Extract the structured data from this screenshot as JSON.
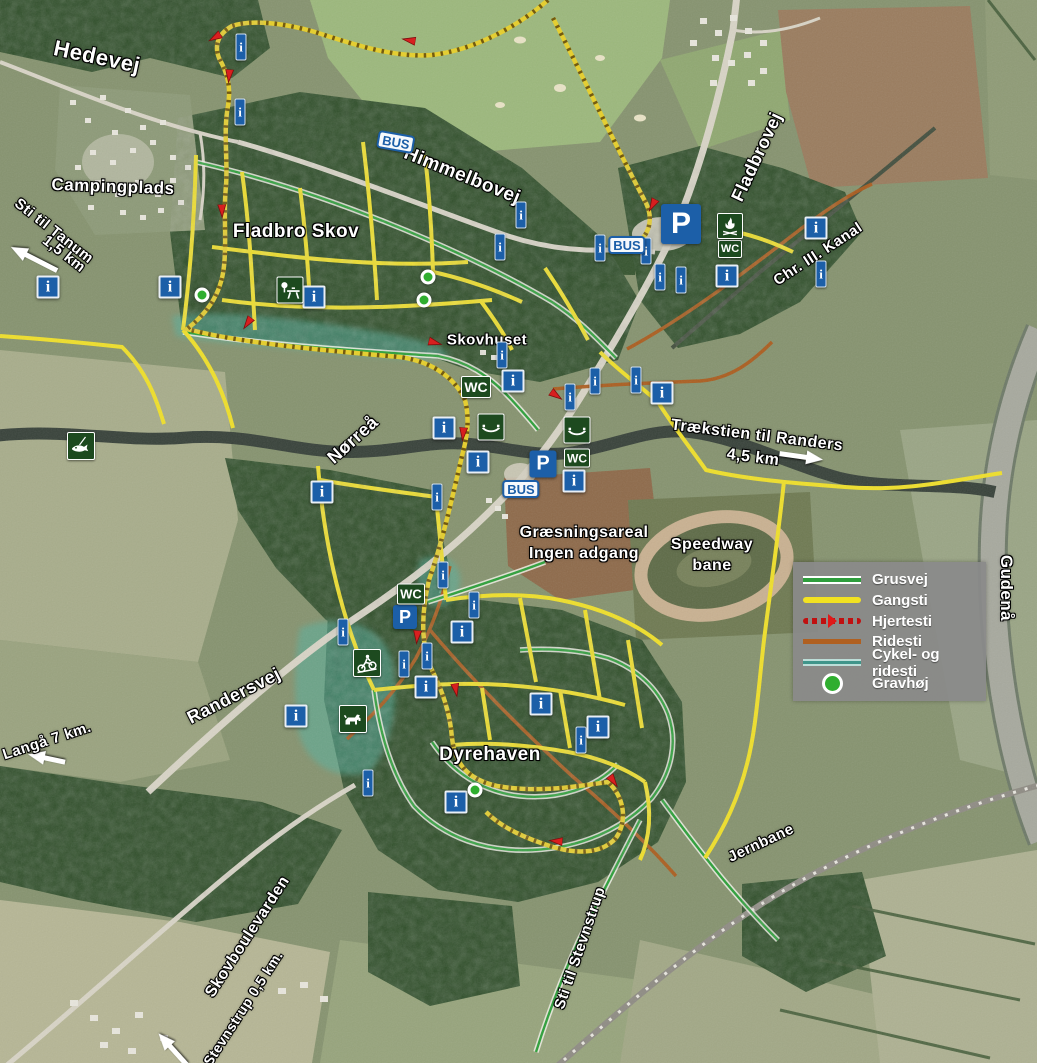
{
  "legend": {
    "items": [
      {
        "label": "Grusvej",
        "type": "grusvej",
        "color": "#2e9e3c"
      },
      {
        "label": "Gangsti",
        "type": "gangsti",
        "color": "#f2e222"
      },
      {
        "label": "Hjertesti",
        "type": "hjertesti",
        "color": "#c01010"
      },
      {
        "label": "Ridesti",
        "type": "ridesti",
        "color": "#b06020"
      },
      {
        "label": "Cykel- og ridesti",
        "type": "cykel",
        "color": "#3f958a"
      },
      {
        "label": "Gravhøj",
        "type": "gravhoj",
        "color": "#2fae2f"
      }
    ]
  },
  "labels": [
    {
      "text": "Hedevej",
      "x": 97,
      "y": 57,
      "rot": 12,
      "size": 22
    },
    {
      "text": "Campingplads",
      "x": 113,
      "y": 187,
      "rot": 2,
      "size": 17
    },
    {
      "text": "Sti til Tanum",
      "x": 54,
      "y": 231,
      "rot": 38,
      "size": 15
    },
    {
      "text": "1,5 km",
      "x": 64,
      "y": 254,
      "rot": 38,
      "size": 15
    },
    {
      "text": "Fladbro Skov",
      "x": 296,
      "y": 232,
      "rot": 0,
      "size": 19
    },
    {
      "text": "Himmelbovej",
      "x": 462,
      "y": 176,
      "rot": 22,
      "size": 19
    },
    {
      "text": "Fladbrovej",
      "x": 757,
      "y": 157,
      "rot": -65,
      "size": 18
    },
    {
      "text": "Chr. III. Kanal",
      "x": 818,
      "y": 254,
      "rot": -33,
      "size": 15
    },
    {
      "text": "Skovhuset",
      "x": 487,
      "y": 340,
      "rot": 0,
      "size": 15
    },
    {
      "text": "Nørreå",
      "x": 353,
      "y": 440,
      "rot": -42,
      "size": 18
    },
    {
      "text": "Trækstien til Randers",
      "x": 757,
      "y": 436,
      "rot": 7,
      "size": 16
    },
    {
      "text": "4,5 km",
      "x": 753,
      "y": 458,
      "rot": 7,
      "size": 16
    },
    {
      "text": "Græsningsareal",
      "x": 584,
      "y": 533,
      "rot": 0,
      "size": 16
    },
    {
      "text": "Ingen adgang",
      "x": 584,
      "y": 554,
      "rot": 0,
      "size": 16
    },
    {
      "text": "Speedway",
      "x": 712,
      "y": 545,
      "rot": 0,
      "size": 16
    },
    {
      "text": "bane",
      "x": 712,
      "y": 566,
      "rot": 0,
      "size": 16
    },
    {
      "text": "Gudenå",
      "x": 1006,
      "y": 588,
      "rot": 90,
      "size": 17
    },
    {
      "text": "Randersvej",
      "x": 234,
      "y": 696,
      "rot": -27,
      "size": 18
    },
    {
      "text": "Langå 7 km.",
      "x": 47,
      "y": 741,
      "rot": -18,
      "size": 15
    },
    {
      "text": "Dyrehaven",
      "x": 490,
      "y": 755,
      "rot": 0,
      "size": 19
    },
    {
      "text": "Jernbane",
      "x": 761,
      "y": 843,
      "rot": -25,
      "size": 15
    },
    {
      "text": "Sti til Stevnstrup",
      "x": 580,
      "y": 948,
      "rot": -71,
      "size": 15
    },
    {
      "text": "Skovboulevarden",
      "x": 248,
      "y": 937,
      "rot": -57,
      "size": 16
    },
    {
      "text": "Stevnstrup 0,5 km.",
      "x": 243,
      "y": 1008,
      "rot": -57,
      "size": 14
    }
  ],
  "arrows": [
    {
      "x": 36,
      "y": 257,
      "rot": 207,
      "len": 54
    },
    {
      "x": 800,
      "y": 459,
      "rot": 8,
      "len": 46
    },
    {
      "x": 48,
      "y": 756,
      "rot": 192,
      "len": 40
    },
    {
      "x": 175,
      "y": 1048,
      "rot": 228,
      "len": 44
    }
  ],
  "icons": [
    {
      "type": "info-small",
      "glyph": "i",
      "x": 241,
      "y": 47
    },
    {
      "type": "info-small",
      "glyph": "i",
      "x": 240,
      "y": 112
    },
    {
      "type": "info-small",
      "glyph": "i",
      "x": 521,
      "y": 215
    },
    {
      "type": "info-small",
      "glyph": "i",
      "x": 500,
      "y": 247
    },
    {
      "type": "info-small",
      "glyph": "i",
      "x": 600,
      "y": 248
    },
    {
      "type": "info-small",
      "glyph": "i",
      "x": 646,
      "y": 251
    },
    {
      "type": "info-small",
      "glyph": "i",
      "x": 660,
      "y": 277
    },
    {
      "type": "info-small",
      "glyph": "i",
      "x": 681,
      "y": 280
    },
    {
      "type": "info-small",
      "glyph": "i",
      "x": 821,
      "y": 274
    },
    {
      "type": "info-small",
      "glyph": "i",
      "x": 502,
      "y": 355
    },
    {
      "type": "info-small",
      "glyph": "i",
      "x": 570,
      "y": 397
    },
    {
      "type": "info-small",
      "glyph": "i",
      "x": 595,
      "y": 381
    },
    {
      "type": "info-small",
      "glyph": "i",
      "x": 636,
      "y": 380
    },
    {
      "type": "info-small",
      "glyph": "i",
      "x": 437,
      "y": 497
    },
    {
      "type": "info-small",
      "glyph": "i",
      "x": 443,
      "y": 575
    },
    {
      "type": "info-small",
      "glyph": "i",
      "x": 474,
      "y": 605
    },
    {
      "type": "info-small",
      "glyph": "i",
      "x": 343,
      "y": 632
    },
    {
      "type": "info-small",
      "glyph": "i",
      "x": 427,
      "y": 656
    },
    {
      "type": "info-small",
      "glyph": "i",
      "x": 404,
      "y": 664
    },
    {
      "type": "info-small",
      "glyph": "i",
      "x": 368,
      "y": 783
    },
    {
      "type": "info-small",
      "glyph": "i",
      "x": 581,
      "y": 740
    },
    {
      "type": "info-large",
      "glyph": "i",
      "x": 48,
      "y": 287
    },
    {
      "type": "info-large",
      "glyph": "i",
      "x": 170,
      "y": 287
    },
    {
      "type": "info-large",
      "glyph": "i",
      "x": 314,
      "y": 297
    },
    {
      "type": "info-large",
      "glyph": "i",
      "x": 816,
      "y": 228
    },
    {
      "type": "info-large",
      "glyph": "i",
      "x": 727,
      "y": 276
    },
    {
      "type": "info-large",
      "glyph": "i",
      "x": 513,
      "y": 381
    },
    {
      "type": "info-large",
      "glyph": "i",
      "x": 662,
      "y": 393
    },
    {
      "type": "info-large",
      "glyph": "i",
      "x": 444,
      "y": 428
    },
    {
      "type": "info-large",
      "glyph": "i",
      "x": 478,
      "y": 462
    },
    {
      "type": "info-large",
      "glyph": "i",
      "x": 574,
      "y": 481
    },
    {
      "type": "info-large",
      "glyph": "i",
      "x": 322,
      "y": 492
    },
    {
      "type": "info-large",
      "glyph": "i",
      "x": 462,
      "y": 632
    },
    {
      "type": "info-large",
      "glyph": "i",
      "x": 426,
      "y": 687
    },
    {
      "type": "info-large",
      "glyph": "i",
      "x": 296,
      "y": 716
    },
    {
      "type": "info-large",
      "glyph": "i",
      "x": 541,
      "y": 704
    },
    {
      "type": "info-large",
      "glyph": "i",
      "x": 598,
      "y": 727
    },
    {
      "type": "info-large",
      "glyph": "i",
      "x": 456,
      "y": 802
    },
    {
      "type": "parking",
      "glyph": "P",
      "x": 681,
      "y": 224,
      "size": 40
    },
    {
      "type": "parking",
      "glyph": "P",
      "x": 543,
      "y": 464,
      "size": 27
    },
    {
      "type": "parking",
      "glyph": "P",
      "x": 405,
      "y": 617,
      "size": 24
    },
    {
      "type": "bus-sign",
      "glyph": "BUS",
      "x": 396,
      "y": 142,
      "rot": 10
    },
    {
      "type": "bus-sign",
      "glyph": "BUS",
      "x": 627,
      "y": 245,
      "rot": 0
    },
    {
      "type": "bus-sign",
      "glyph": "BUS",
      "x": 521,
      "y": 489,
      "rot": 0
    },
    {
      "type": "wc",
      "glyph": "WC",
      "x": 476,
      "y": 387,
      "size": 30
    },
    {
      "type": "wc",
      "glyph": "WC",
      "x": 730,
      "y": 249,
      "size": 24
    },
    {
      "type": "wc",
      "glyph": "WC",
      "x": 577,
      "y": 458,
      "size": 26
    },
    {
      "type": "wc",
      "glyph": "WC",
      "x": 411,
      "y": 594,
      "size": 28
    },
    {
      "type": "campfire",
      "x": 730,
      "y": 226,
      "size": 26
    },
    {
      "type": "picnic",
      "x": 290,
      "y": 290,
      "size": 27
    },
    {
      "type": "canoe",
      "x": 491,
      "y": 427,
      "size": 27
    },
    {
      "type": "canoe",
      "x": 577,
      "y": 430,
      "size": 27
    },
    {
      "type": "fishing",
      "x": 81,
      "y": 446,
      "size": 28
    },
    {
      "type": "mtb",
      "x": 367,
      "y": 663,
      "size": 28
    },
    {
      "type": "dog",
      "x": 353,
      "y": 719,
      "size": 28
    },
    {
      "type": "gravhoj",
      "x": 202,
      "y": 295
    },
    {
      "type": "gravhoj",
      "x": 428,
      "y": 277
    },
    {
      "type": "gravhoj",
      "x": 424,
      "y": 300
    },
    {
      "type": "gravhoj",
      "x": 475,
      "y": 790
    },
    {
      "type": "route-arrow",
      "x": 408,
      "y": 40,
      "rot": 190
    },
    {
      "type": "route-arrow",
      "x": 214,
      "y": 38,
      "rot": 150
    },
    {
      "type": "route-arrow",
      "x": 229,
      "y": 77,
      "rot": 95
    },
    {
      "type": "route-arrow",
      "x": 222,
      "y": 212,
      "rot": 88
    },
    {
      "type": "route-arrow",
      "x": 247,
      "y": 324,
      "rot": 125
    },
    {
      "type": "route-arrow",
      "x": 436,
      "y": 343,
      "rot": 15
    },
    {
      "type": "route-arrow",
      "x": 557,
      "y": 396,
      "rot": 35
    },
    {
      "type": "route-arrow",
      "x": 652,
      "y": 206,
      "rot": 118
    },
    {
      "type": "route-arrow",
      "x": 463,
      "y": 435,
      "rot": 95
    },
    {
      "type": "route-arrow",
      "x": 417,
      "y": 638,
      "rot": 95
    },
    {
      "type": "route-arrow",
      "x": 456,
      "y": 691,
      "rot": 80
    },
    {
      "type": "route-arrow",
      "x": 614,
      "y": 782,
      "rot": 55
    },
    {
      "type": "route-arrow",
      "x": 555,
      "y": 841,
      "rot": 185
    }
  ],
  "colors": {
    "grusvej": "#2e9e3c",
    "gangsti": "#efdf2b",
    "hjertesti": "#c01010",
    "ridesti": "#ad5c1c",
    "cykel_ridesti": "#3f958a",
    "info_blue": "#1c5fa8",
    "icon_green": "#1d4a1f"
  }
}
